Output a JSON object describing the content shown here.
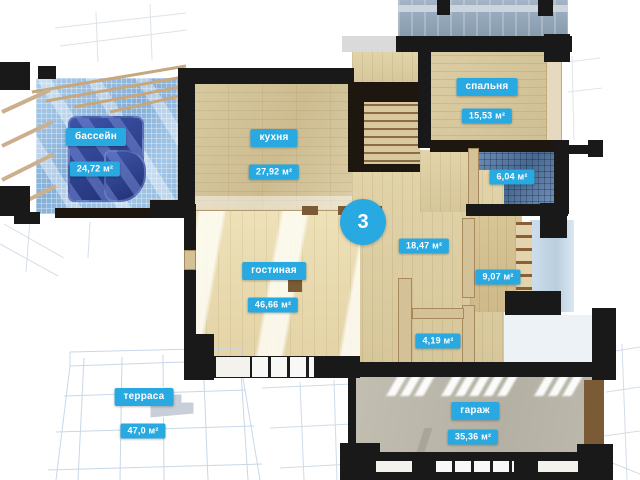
{
  "floor": {
    "badge": "3"
  },
  "rooms": [
    {
      "key": "pool",
      "name": "бассейн",
      "area": "24,72 м²"
    },
    {
      "key": "kitchen",
      "name": "кухня",
      "area": "27,92 м²"
    },
    {
      "key": "bedroom",
      "name": "спальня",
      "area": "15,53 м²"
    },
    {
      "key": "bathroom",
      "name": "",
      "area": "6,04 м²"
    },
    {
      "key": "hall",
      "name": "",
      "area": "18,47 м²"
    },
    {
      "key": "corridor",
      "name": "",
      "area": "9,07 м²"
    },
    {
      "key": "living",
      "name": "гостиная",
      "area": "46,66 м²"
    },
    {
      "key": "storage",
      "name": "",
      "area": "4,19 м²"
    },
    {
      "key": "terrace",
      "name": "терраса",
      "area": "47,0 м²"
    },
    {
      "key": "garage",
      "name": "гараж",
      "area": "35,36 м²"
    }
  ],
  "colors": {
    "accent": "#29a9e2",
    "wall": "#191919",
    "pool_water": "#2c3f8c"
  }
}
